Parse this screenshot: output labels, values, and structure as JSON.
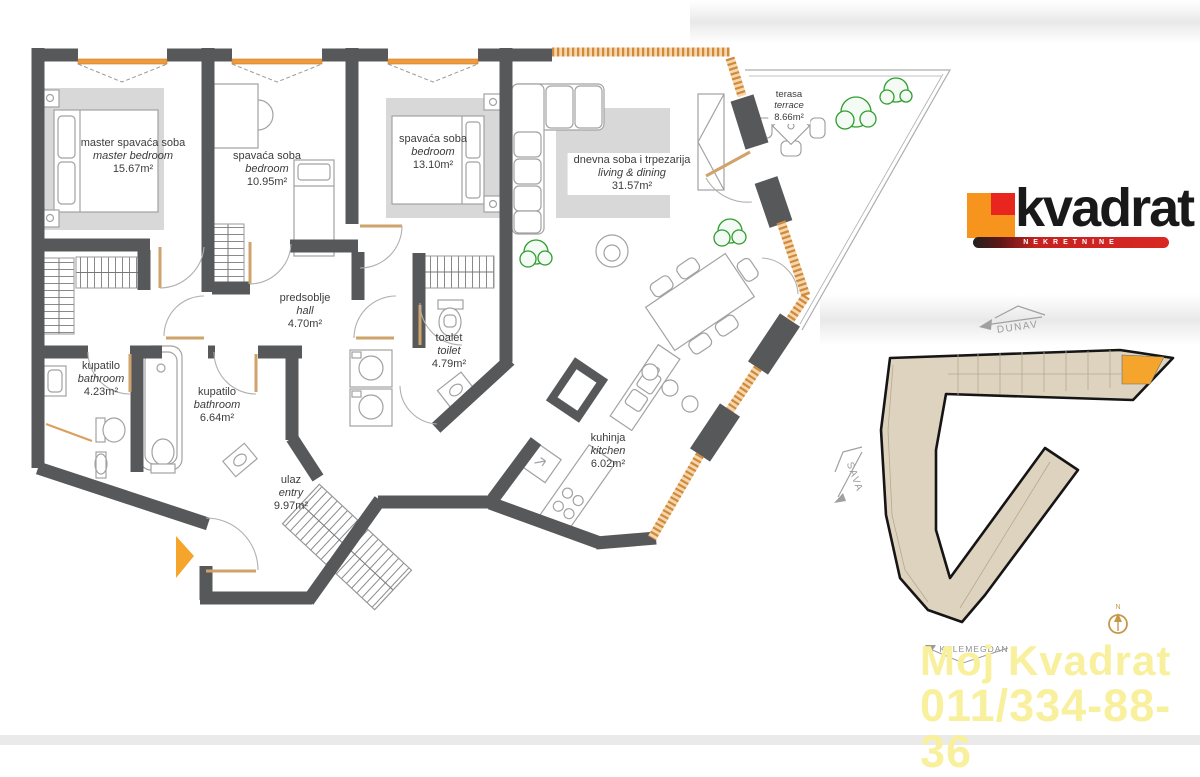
{
  "rooms": [
    {
      "name": "master spavaća soba",
      "name_en": "master bedroom",
      "area": "15.67m²"
    },
    {
      "name": "spavaća soba",
      "name_en": "bedroom",
      "area": "10.95m²"
    },
    {
      "name": "spavaća soba",
      "name_en": "bedroom",
      "area": "13.10m²"
    },
    {
      "name": "dnevna soba i trpezarija",
      "name_en": "living & dining",
      "area": "31.57m²"
    },
    {
      "name": "terasa",
      "name_en": "terrace",
      "area": "8.66m²"
    },
    {
      "name": "predsoblje",
      "name_en": "hall",
      "area": "4.70m²"
    },
    {
      "name": "toalet",
      "name_en": "toilet",
      "area": "4.79m²"
    },
    {
      "name": "kupatilo",
      "name_en": "bathroom",
      "area": "4.23m²"
    },
    {
      "name": "kupatilo",
      "name_en": "bathroom",
      "area": "6.64m²"
    },
    {
      "name": "ulaz",
      "name_en": "entry",
      "area": "9.97m²"
    },
    {
      "name": "kuhinja",
      "name_en": "kitchen",
      "area": "6.02m²"
    }
  ],
  "logo": {
    "brand": "kvadrat",
    "tagline": "NEKRETNINE"
  },
  "site_plan": {
    "river_north": "DUNAV",
    "river_west": "SAVA",
    "landmark": "KALEMEGDAN",
    "compass": "N"
  },
  "watermark": {
    "line1": "Moj Kvadrat",
    "line2": "011/334-88-36"
  },
  "colors": {
    "wall": "#57585a",
    "window_orange": "#f09a3e",
    "glazing_orange": "#cf8a3c",
    "highlighted_unit": "#f5a52b",
    "building_fill": "#ded3bf",
    "plant_green": "#2e9e2e",
    "furniture_gray": "#d8d8d8",
    "watermark_yellow": "#f8f09c",
    "logo_orange": "#f7941e",
    "logo_red": "#e8251f"
  }
}
